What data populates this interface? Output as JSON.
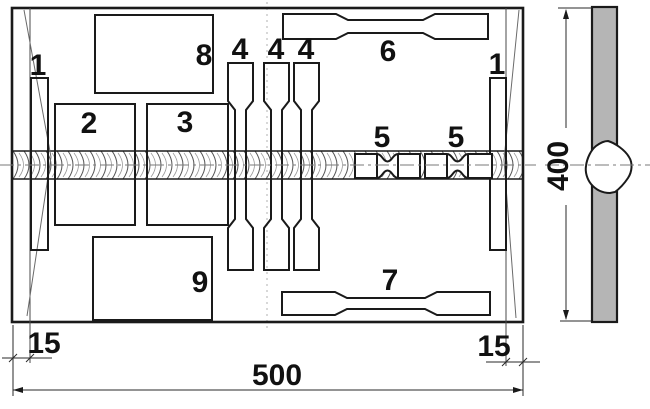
{
  "figure": {
    "type": "weld-test-plate-cutting-plan",
    "plate": {
      "width_label": "500",
      "height_label": "400",
      "edge_margin_left": "15",
      "edge_margin_right": "15"
    },
    "specimens": {
      "strip_left": "1",
      "strip_right": "1",
      "block_2": "2",
      "block_3": "3",
      "dogbone_vertical": [
        "4",
        "4",
        "4"
      ],
      "micro_weld": [
        "5",
        "5"
      ],
      "dogbone_top": "6",
      "dogbone_bottom": "7",
      "block_8": "8",
      "block_9": "9"
    },
    "colors": {
      "line": "#1a1a1a",
      "plate_fill": "#b5b5b5",
      "background": "#ffffff"
    }
  }
}
